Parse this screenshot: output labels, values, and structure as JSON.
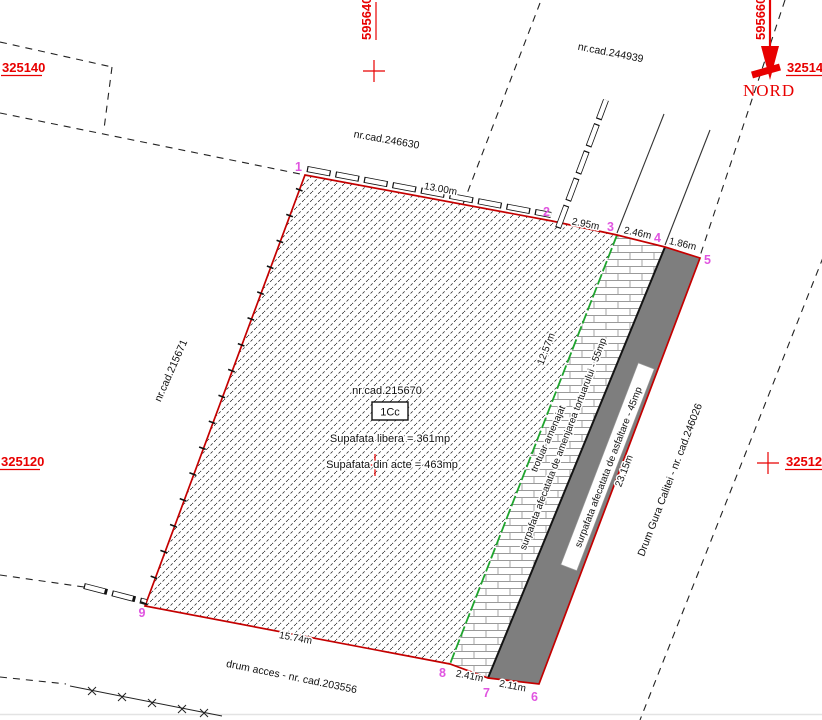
{
  "grid": {
    "x_top_left": "325140",
    "x_top_right": "325140",
    "y_mid_left": "325120",
    "y_mid_right": "325120",
    "v_line_center": "595640",
    "v_line_right": "595660"
  },
  "north_label": "NORD",
  "cadastral": {
    "neighbor_top_right": "nr.cad.244939",
    "neighbor_top_left": "nr.cad.246630",
    "neighbor_left": "nr.cad.215671",
    "parcel_nr": "nr.cad.215670",
    "parcel_code": "1Cc",
    "area_free": "Supafata libera = 361mp",
    "area_deed": "Supafata din acte = 463mp",
    "road_access": "drum acces - nr. cad.203556",
    "road_main": "Drum Gura Calitei - nr. cad.246026",
    "sidewalk_note": "trotuar amenajat",
    "area_sidewalk": "surpafata afecatata de amenjarea tortuarului - 55mp",
    "area_asphalt": "surpafata afecatata de asfaltare - 45mp"
  },
  "dimensions": {
    "seg_1_2": "13.00m",
    "seg_2_3": "2.95m",
    "seg_3_4": "2.46m",
    "seg_4_5": "1.86m",
    "seg_5_6": "23.15m",
    "seg_6_7": "2.11m",
    "seg_7_8": "2.41m",
    "seg_8_9": "15.74m",
    "seg_green": "12.57m"
  },
  "points": {
    "p1": "1",
    "p2": "2",
    "p3": "3",
    "p4": "4",
    "p5": "5",
    "p6": "6",
    "p7": "7",
    "p8": "8",
    "p9": "9"
  },
  "colors": {
    "boundary_red": "#c40000",
    "grid_red": "#e80000",
    "point_magenta": "#e054e0",
    "green_line": "#1fa42e",
    "green_text": "#2fc62f",
    "asphalt_gray": "#7e7e7e"
  }
}
